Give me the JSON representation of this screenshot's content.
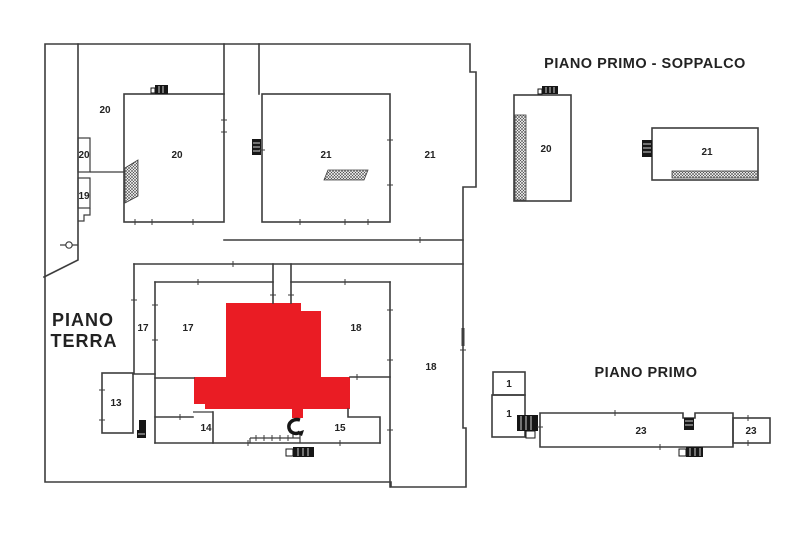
{
  "titles": {
    "ground_floor_line1": "PIANO",
    "ground_floor_line2": "TERRA",
    "mezzanine": "PIANO PRIMO - SOPPALCO",
    "first_floor": "PIANO PRIMO"
  },
  "rooms": {
    "gt_20_corridor": "20",
    "gt_20_small": "20",
    "gt_19": "19",
    "gt_20_main": "20",
    "gt_21_main": "21",
    "gt_21_right": "21",
    "gt_17_strip": "17",
    "gt_17_main": "17",
    "gt_18_main": "18",
    "gt_18_strip": "18",
    "gt_13": "13",
    "gt_14": "14",
    "gt_15": "15",
    "sp_20": "20",
    "sp_21": "21",
    "pp_1_upper": "1",
    "pp_1_lower": "1",
    "pp_23_main": "23",
    "pp_23_right": "23"
  },
  "colors": {
    "highlight": "#ea1c24",
    "wall": "#3d3d3d",
    "background": "#ffffff"
  }
}
